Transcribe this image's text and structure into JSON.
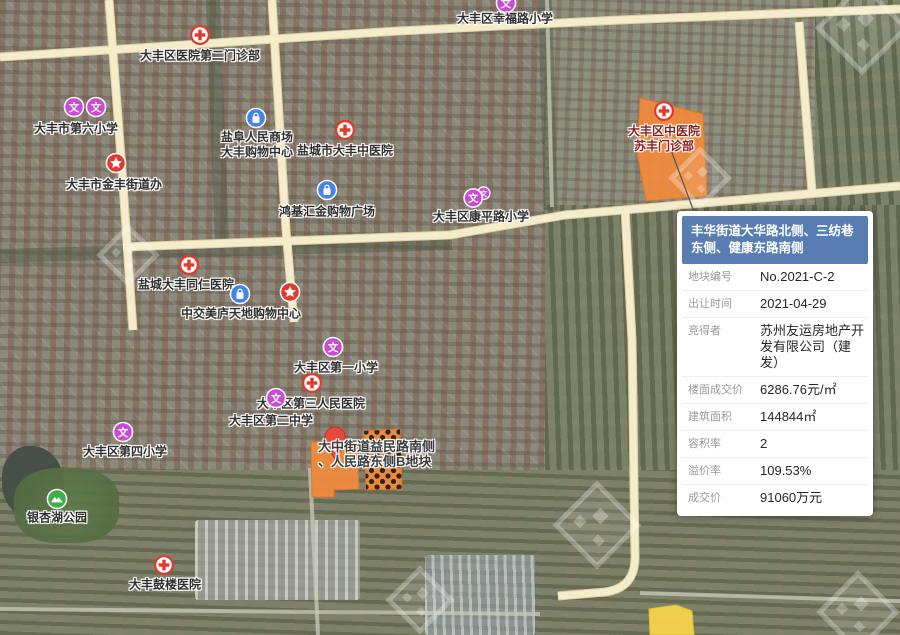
{
  "popup": {
    "title": "丰华街道大华路北侧、三纺巷东侧、健康东路南侧",
    "rows": [
      {
        "label": "地块编号",
        "value": "No.2021-C-2"
      },
      {
        "label": "出让时间",
        "value": "2021-04-29"
      },
      {
        "label": "竞得者",
        "value": "苏州友运房地产开发有限公司（建发）"
      },
      {
        "label": "楼面成交价",
        "value": "6286.76元/㎡"
      },
      {
        "label": "建筑面积",
        "value": "144844㎡"
      },
      {
        "label": "容积率",
        "value": "2"
      },
      {
        "label": "溢价率",
        "value": "109.53%"
      },
      {
        "label": "成交价",
        "value": "91060万元"
      }
    ]
  },
  "map": {
    "pois": [
      {
        "id": "hospital-dafeng-no2-clinic",
        "icon": "hospital",
        "x": 200,
        "y": 35,
        "lines": [
          "大丰区医院第二门诊部"
        ],
        "lx": 200,
        "ly": 56
      },
      {
        "id": "school-xingfulu",
        "icon": "school",
        "x": 506,
        "y": 3,
        "lines": [
          "大丰区幸福路小学"
        ],
        "lx": 505,
        "ly": 19
      },
      {
        "id": "school-no6-icon-a",
        "icon": "school",
        "x": 74,
        "y": 107,
        "lines": [],
        "lx": 0,
        "ly": 0
      },
      {
        "id": "school-no6",
        "icon": "school",
        "x": 96,
        "y": 107,
        "lines": [
          "大丰市第六小学"
        ],
        "lx": 76,
        "ly": 129
      },
      {
        "id": "gov-jinfeng-street",
        "icon": "star",
        "x": 116,
        "y": 163,
        "lines": [
          "大丰市金丰街道办"
        ],
        "lx": 114,
        "ly": 185
      },
      {
        "id": "mall-yanfu",
        "icon": "mall",
        "x": 256,
        "y": 118,
        "lines": [
          "盐阜人民商场",
          "大丰购物中心"
        ],
        "lx": 257,
        "ly": 145
      },
      {
        "id": "hospital-dafeng-tcm",
        "icon": "hospital",
        "x": 345,
        "y": 130,
        "lines": [
          "盐城市大丰中医院"
        ],
        "lx": 345,
        "ly": 151
      },
      {
        "id": "mall-hongjihuijin",
        "icon": "mall",
        "x": 327,
        "y": 190,
        "lines": [
          "鸿基汇金购物广场"
        ],
        "lx": 327,
        "ly": 212
      },
      {
        "id": "school-kangpinglu",
        "icon": "school2",
        "x": 477,
        "y": 197,
        "lines": [
          "大丰区康平路小学"
        ],
        "lx": 481,
        "ly": 217
      },
      {
        "id": "hospital-tongren",
        "icon": "hospital",
        "x": 189,
        "y": 265,
        "lines": [
          "盐城大丰同仁医院"
        ],
        "lx": 186,
        "ly": 285
      },
      {
        "id": "mall-zhongjiao-icon",
        "icon": "mall",
        "x": 240,
        "y": 294,
        "lines": [],
        "lx": 0,
        "ly": 0
      },
      {
        "id": "poi-zhongjiao-meilu",
        "icon": "star",
        "x": 290,
        "y": 292,
        "lines": [
          "中交美庐天地购物中心"
        ],
        "lx": 241,
        "ly": 314
      },
      {
        "id": "school-no1-primary",
        "icon": "school",
        "x": 333,
        "y": 347,
        "lines": [
          "大丰区第一小学"
        ],
        "lx": 336,
        "ly": 368
      },
      {
        "id": "hospital-no3-people",
        "icon": "hospital",
        "x": 312,
        "y": 383,
        "lines": [
          "大丰区第三人民医院"
        ],
        "lx": 311,
        "ly": 404
      },
      {
        "id": "school-no2-middle",
        "icon": "school",
        "x": 276,
        "y": 398,
        "lines": [
          "大丰区第二中学"
        ],
        "lx": 271,
        "ly": 421
      },
      {
        "id": "school-no4-primary",
        "icon": "school",
        "x": 123,
        "y": 432,
        "lines": [
          "大丰区第四小学"
        ],
        "lx": 125,
        "ly": 452
      },
      {
        "id": "park-yinxinghu",
        "icon": "park",
        "x": 57,
        "y": 499,
        "lines": [
          "银杏湖公园"
        ],
        "lx": 57,
        "ly": 518
      },
      {
        "id": "hospital-gulou",
        "icon": "hospital",
        "x": 164,
        "y": 565,
        "lines": [
          "大丰鼓楼医院"
        ],
        "lx": 165,
        "ly": 585
      },
      {
        "id": "hospital-tcm-sufeng",
        "icon": "hospital",
        "x": 664,
        "y": 111,
        "lines": [
          "大丰区中医院",
          "苏丰门诊部"
        ],
        "lx": 664,
        "ly": 139,
        "color": "#8a1d1d"
      }
    ],
    "parcel_label": {
      "lines": [
        "大中街道益民路南侧",
        "、人民路东侧B地块"
      ]
    },
    "parcels": [
      {
        "id": "parcel-2021-c-2",
        "points": "640,98 703,114 707,196 646,201 637,152",
        "fill": "#f08a3e",
        "stroke": "#e2762a",
        "dots": false
      },
      {
        "id": "parcel-yimin-a",
        "points": "311,442 357,440 359,489 334,490 334,497 312,497",
        "fill": "#f08a3e",
        "stroke": "#e2762a",
        "dots": false
      },
      {
        "id": "parcel-yimin-b",
        "points": "364,431 400,429 402,489 366,490",
        "fill": "#f08a3e",
        "stroke": "#e2762a",
        "dots": true
      },
      {
        "id": "parcel-yellow-south",
        "points": "649,609 676,605 692,611 694,635 650,635",
        "fill": "#f6d44c",
        "stroke": "#e5c232",
        "dots": false
      }
    ],
    "roads": {
      "major": [
        "M0,57 L398,31 L620,20 L900,9",
        "M109,0 L122,170 L133,330",
        "M272,0 L286,230 L294,322",
        "M123,247 L450,235 L565,215 L900,186",
        "M625,208 L632,340 L635,555 Q636,588 605,592 L558,596",
        "M799,22 L812,192"
      ],
      "minor": [
        "M547,0 L552,207",
        "M640,593 L900,601",
        "M0,609 L540,614",
        "M310,468 L318,635"
      ],
      "tree_lines": [
        "M0,256 L452,243",
        "M213,0 L222,243",
        "M545,0 L551,210"
      ]
    },
    "pin": {
      "x": 335,
      "y": 437
    },
    "leader": "M671,150 L694,212",
    "watermarks": [
      {
        "x": 862,
        "y": 28,
        "s": 62
      },
      {
        "x": 700,
        "y": 178,
        "s": 40
      },
      {
        "x": 597,
        "y": 525,
        "s": 58
      },
      {
        "x": 858,
        "y": 612,
        "s": 54
      },
      {
        "x": 128,
        "y": 255,
        "s": 40
      },
      {
        "x": 420,
        "y": 600,
        "s": 44
      }
    ],
    "colors": {
      "road_fill": "#f5eccb",
      "road_casing": "#dccf9f",
      "minor_road": "#c9c9ba",
      "hospital_red": "#e23b2e",
      "school_purple": "#cb4bd3",
      "mall_blue": "#4484e4",
      "park_green": "#3faf4b",
      "pin_red": "#e8483b",
      "header_blue": "#587db3",
      "parcel_orange": "#f08a3e"
    }
  }
}
